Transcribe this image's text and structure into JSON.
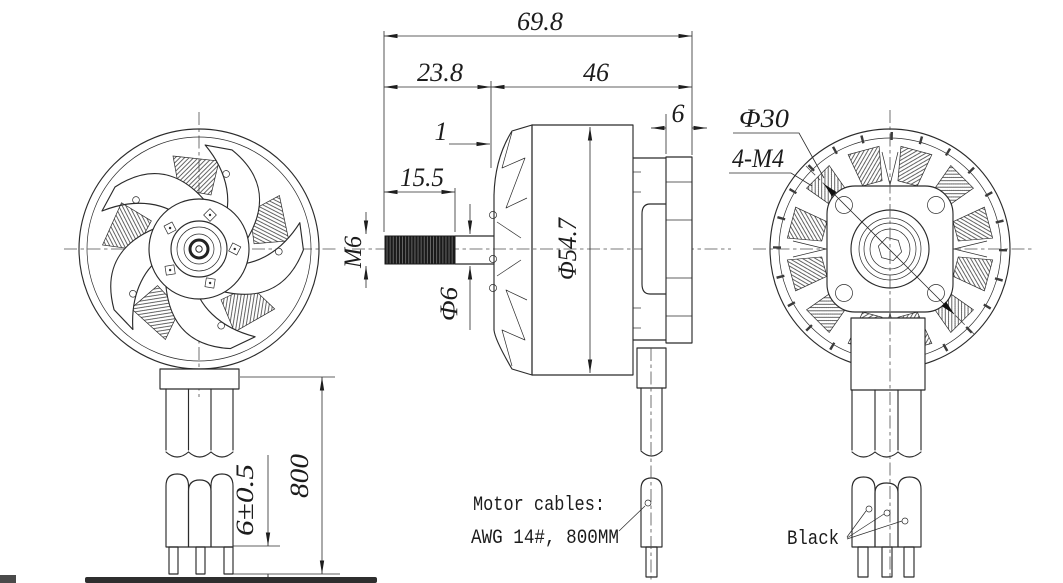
{
  "drawing": {
    "background": "#ffffff",
    "line_color": "#2b2b2b"
  },
  "dimensions": {
    "overall_length": "69.8",
    "shaft_section_length": "23.8",
    "body_length": "46",
    "mount_flange_thickness": "6",
    "shoulder_gap": "1",
    "thread_length": "15.5",
    "shaft_thread": "M6",
    "shaft_diameter": "Φ6",
    "body_diameter": "Φ54.7",
    "bolt_circle_diameter": "Φ30",
    "mount_holes": "4-M4",
    "stripped_wire_length": "6±0.5",
    "cable_length": "800"
  },
  "notes": {
    "cable_note_line1": "Motor cables:",
    "cable_note_line2": "AWG 14#, 800MM",
    "wire_color": "Black"
  }
}
